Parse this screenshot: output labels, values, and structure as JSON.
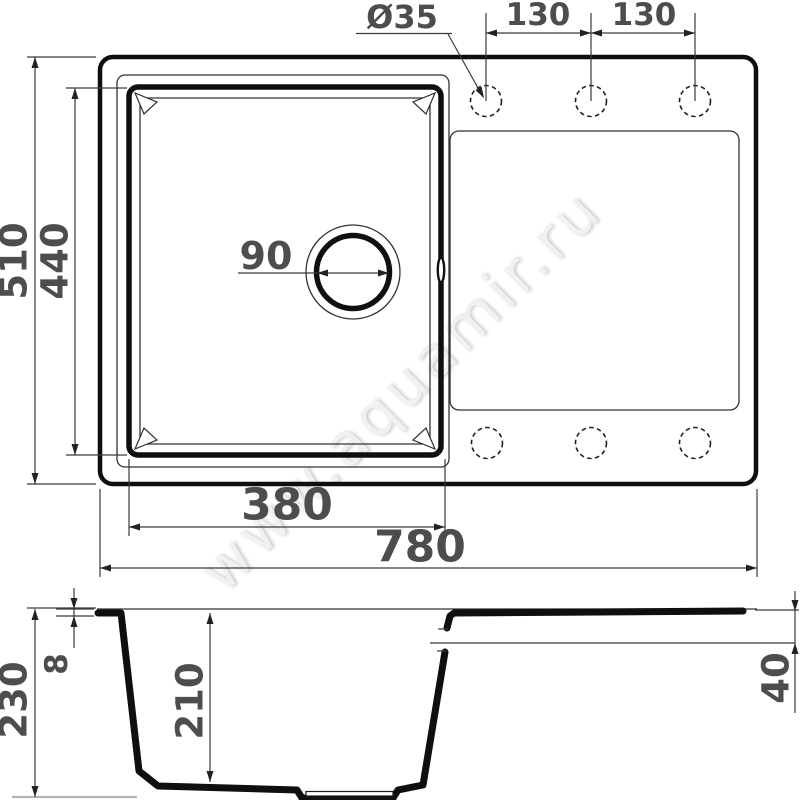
{
  "watermark": {
    "text": "www.aquamir.ru"
  },
  "top_view": {
    "faucet_hole_diameter_label": "Ø35",
    "hole_spacing_left": "130",
    "hole_spacing_right": "130",
    "overall_depth": "510",
    "bowl_inner_depth": "440",
    "drain_diameter": "90",
    "bowl_inner_width": "380",
    "overall_width": "780"
  },
  "section_view": {
    "overall_height": "230",
    "rim_thickness": "8",
    "bowl_depth": "210",
    "drainboard_drop": "40"
  },
  "colors": {
    "line": "#0f0f0f",
    "dim_text": "#4d4d4d",
    "watermark": "#f1f1f1"
  }
}
